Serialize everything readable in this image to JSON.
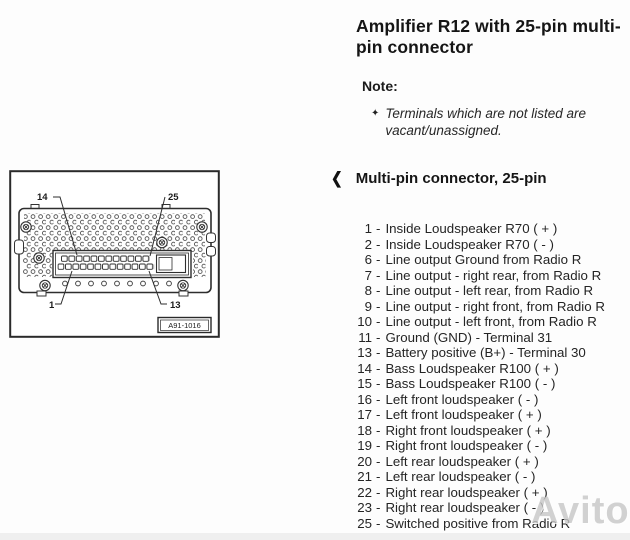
{
  "header": {
    "title": "Amplifier R12 with 25-pin multi-pin connector"
  },
  "note": {
    "label": "Note:",
    "bullet": "✦",
    "text": "Terminals which are not listed are vacant/unassigned."
  },
  "section": {
    "arrow": "❮",
    "heading": "Multi-pin connector, 25-pin"
  },
  "pin_list": {
    "separator": "-",
    "rows": [
      {
        "num": "1",
        "desc": "Inside Loudspeaker R70 ( + )"
      },
      {
        "num": "2",
        "desc": "Inside Loudspeaker R70 ( - )"
      },
      {
        "num": "6",
        "desc": "Line output Ground from Radio R"
      },
      {
        "num": "7",
        "desc": "Line output - right rear, from Radio R"
      },
      {
        "num": "8",
        "desc": "Line output - left rear, from Radio R"
      },
      {
        "num": "9",
        "desc": "Line output - right front, from Radio R"
      },
      {
        "num": "10",
        "desc": "Line output - left front, from Radio R"
      },
      {
        "num": "11",
        "desc": "Ground (GND) - Terminal 31"
      },
      {
        "num": "13",
        "desc": "Battery positive (B+) - Terminal 30"
      },
      {
        "num": "14",
        "desc": "Bass Loudspeaker R100 ( + )"
      },
      {
        "num": "15",
        "desc": "Bass Loudspeaker R100 ( - )"
      },
      {
        "num": "16",
        "desc": "Left front loudspeaker ( - )"
      },
      {
        "num": "17",
        "desc": "Left front loudspeaker ( + )"
      },
      {
        "num": "18",
        "desc": "Right front loudspeaker ( + )"
      },
      {
        "num": "19",
        "desc": "Right front loudspeaker ( - )"
      },
      {
        "num": "20",
        "desc": "Left rear loudspeaker ( + )"
      },
      {
        "num": "21",
        "desc": "Left rear loudspeaker ( - )"
      },
      {
        "num": "22",
        "desc": "Right rear loudspeaker ( + )"
      },
      {
        "num": "23",
        "desc": "Right rear loudspeaker ( - )"
      },
      {
        "num": "25",
        "desc": "Switched positive from Radio R"
      }
    ]
  },
  "diagram": {
    "callouts": {
      "top_left": "14",
      "top_right": "25",
      "bottom_left": "1",
      "bottom_right": "13"
    },
    "figure_label": "A91-1016"
  },
  "watermark": {
    "text": "Avito"
  },
  "colors": {
    "text": "#1f1f1f",
    "line": "#2e2e2e",
    "watermark": "#c7c7c7"
  }
}
